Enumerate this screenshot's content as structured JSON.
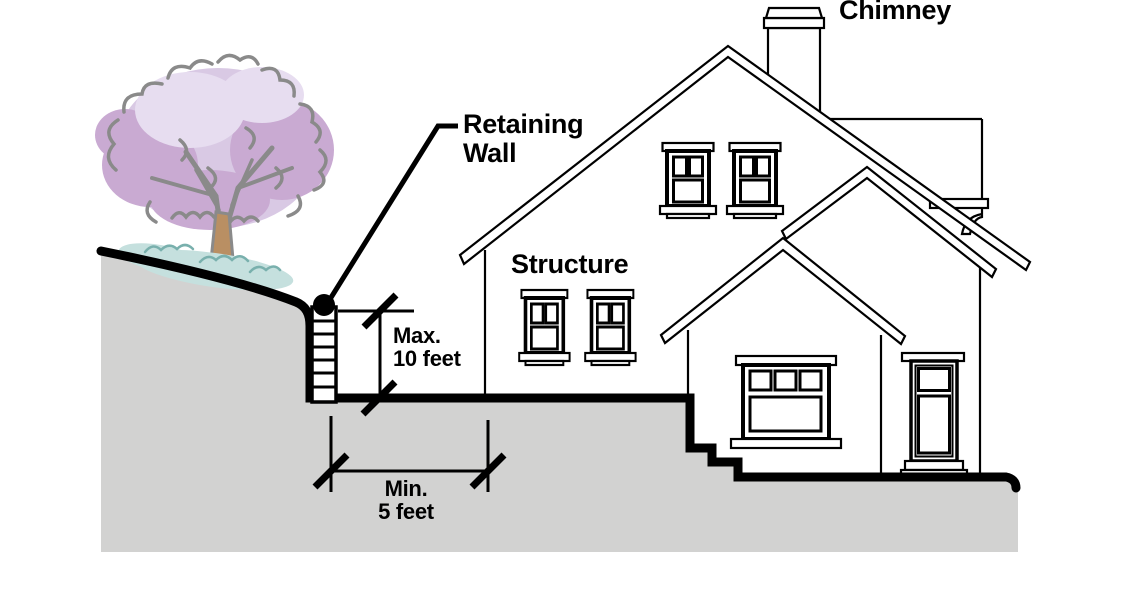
{
  "diagram": {
    "labels": {
      "chimney": "Chimney",
      "retaining_wall_line1": "Retaining",
      "retaining_wall_line2": "Wall",
      "structure": "Structure"
    },
    "dimensions": {
      "wall_height": {
        "line1": "Max.",
        "line2": "10 feet",
        "value_feet": 10
      },
      "setback": {
        "line1": "Min.",
        "line2": "5 feet",
        "value_feet": 5
      }
    },
    "colors": {
      "ground": "#d2d2d1",
      "line": "#000000",
      "foliage_light": "#d9c9e4",
      "foliage_mid": "#c9aad2",
      "foliage_pale": "#e7ddf0",
      "foliage_outline": "#8a8a8a",
      "bush": "#c5e0de",
      "bush_outline": "#79b0ad",
      "trunk": "#b98f63"
    }
  }
}
